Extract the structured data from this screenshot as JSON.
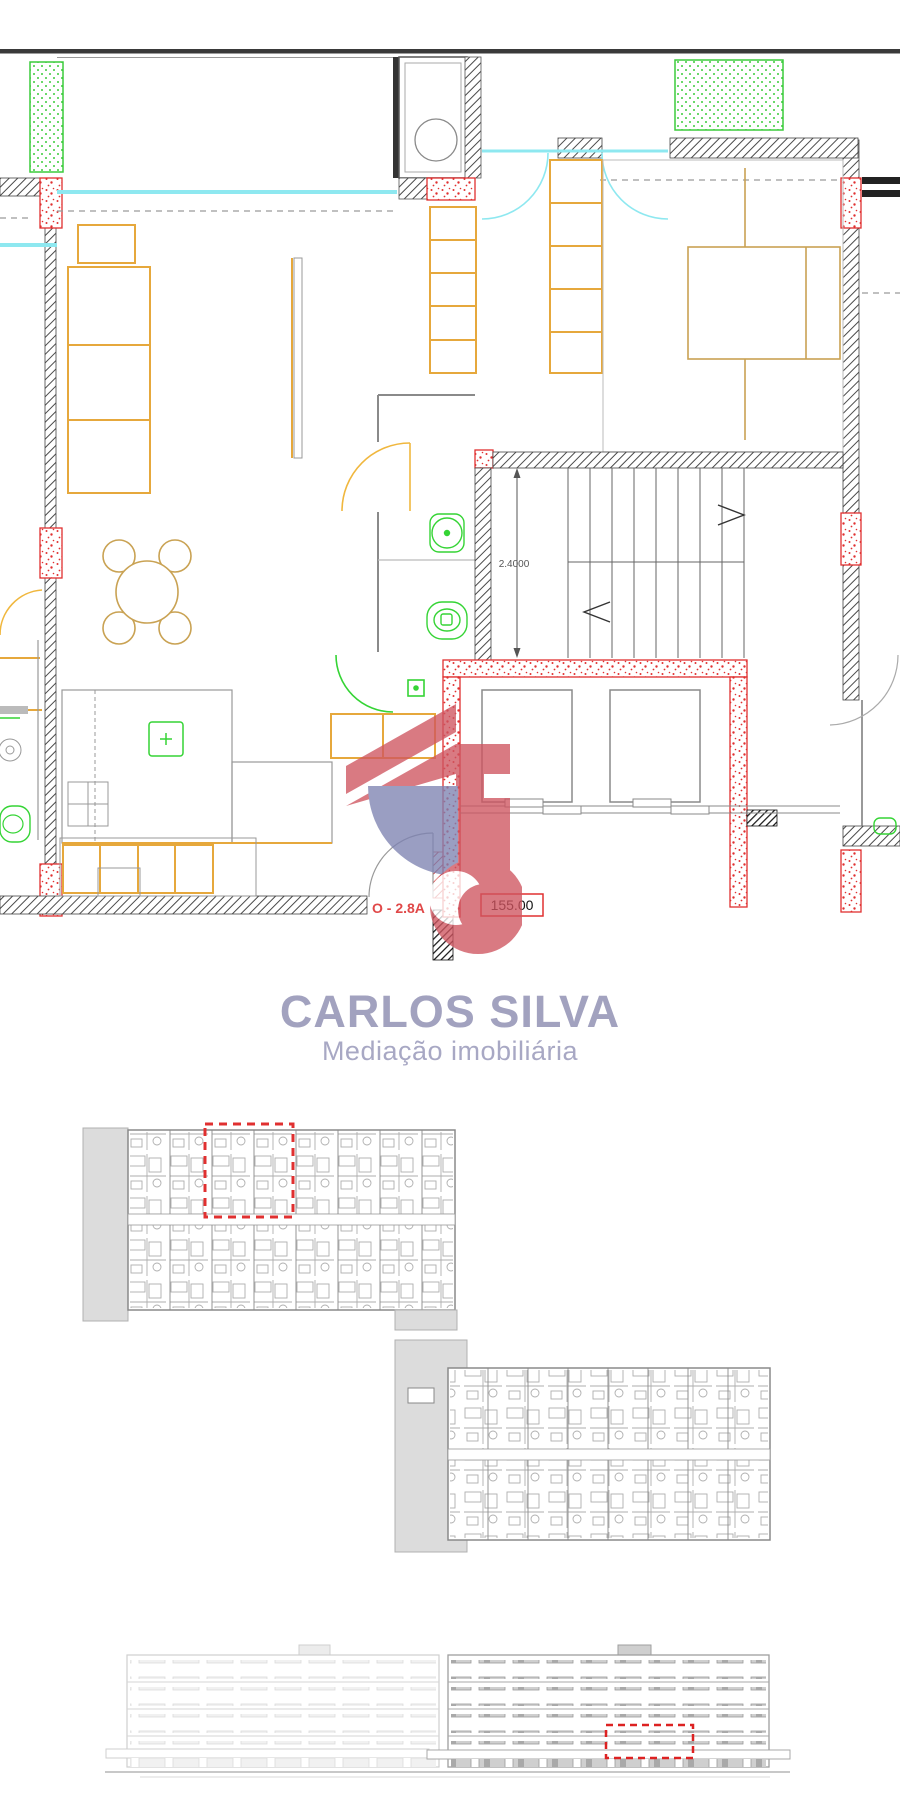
{
  "brand": {
    "name": "CARLOS SILVA",
    "tagline": "Mediação imobiliária",
    "title_color": "#a2a2bf",
    "logo_red": "#cf5560",
    "logo_blue": "#7e83b2"
  },
  "plan": {
    "unit_label": "O - 2.8A",
    "area_label": "155.00",
    "stair_dimension": "2.4000",
    "colors": {
      "furniture_orange": "#e6a83c",
      "furniture_tan": "#c9a253",
      "fixtures_green": "#35d435",
      "window_cyan": "#8ee8f0",
      "wall_hatch_gray": "#4a4a4a",
      "column_stipple_red": "#e03030",
      "dimension_text": "#555555"
    }
  },
  "overview": {
    "highlight_color": "#e03030"
  },
  "elevation": {
    "highlight_color": "#dd2222"
  }
}
